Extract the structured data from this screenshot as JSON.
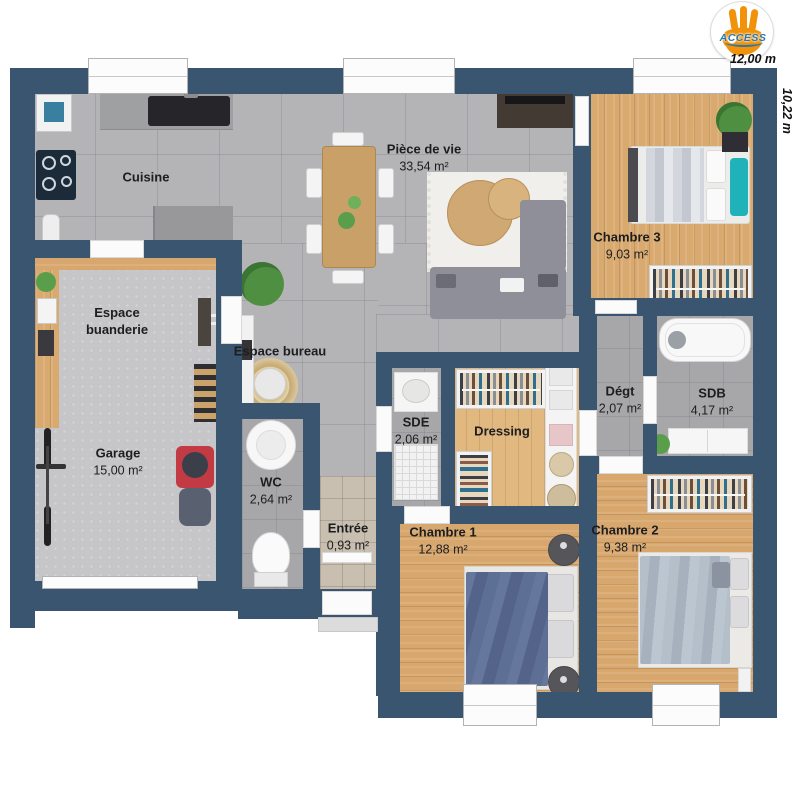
{
  "logo": {
    "brand": "ACCESS"
  },
  "dimensions": {
    "width_label": "12,00 m",
    "height_label": "10,22 m"
  },
  "rooms": {
    "piece_de_vie": {
      "name": "Pièce de vie",
      "area": "33,54 m²"
    },
    "cuisine": {
      "name": "Cuisine",
      "area": ""
    },
    "chambre3": {
      "name": "Chambre 3",
      "area": "9,03 m²"
    },
    "buanderie": {
      "name": "Espace buanderie",
      "area": ""
    },
    "bureau": {
      "name": "Espace bureau",
      "area": ""
    },
    "garage": {
      "name": "Garage",
      "area": "15,00 m²"
    },
    "wc": {
      "name": "WC",
      "area": "2,64 m²"
    },
    "sde": {
      "name": "SDE",
      "area": "2,06 m²"
    },
    "dressing": {
      "name": "Dressing",
      "area": ""
    },
    "degt": {
      "name": "Dégt",
      "area": "2,07 m²"
    },
    "sdb": {
      "name": "SDB",
      "area": "4,17 m²"
    },
    "entree": {
      "name": "Entrée",
      "area": "0,93 m²"
    },
    "chambre1": {
      "name": "Chambre 1",
      "area": "12,88 m²"
    },
    "chambre2": {
      "name": "Chambre 2",
      "area": "9,38 m²"
    }
  },
  "colors": {
    "wall": "#3a556f",
    "teal": "#1fb2b8",
    "mower_red": "#c23a44",
    "brand_blue": "#2878ab"
  }
}
